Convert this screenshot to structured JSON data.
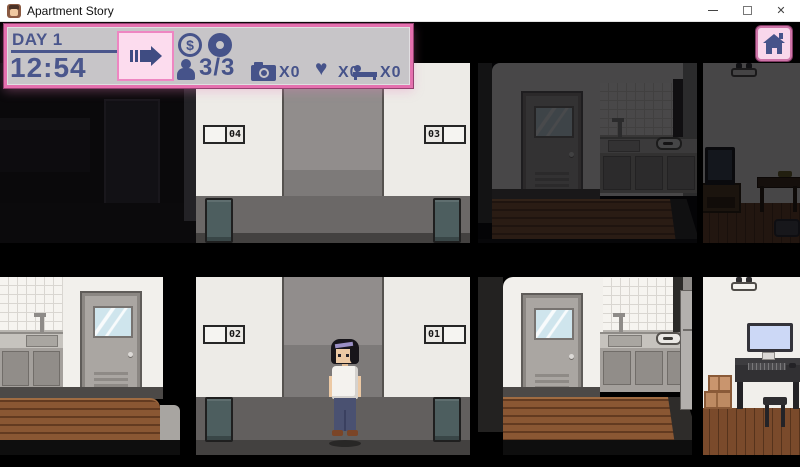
{
  "window": {
    "title": "Apartment Story",
    "close_glyph": "✕"
  },
  "hud": {
    "day": "DAY 1",
    "time": "12:54",
    "money_symbol": "$",
    "tenants": "3/3",
    "stats": {
      "camera": "x0",
      "heart": "x0",
      "bed": "x0"
    }
  },
  "rooms": {
    "plates": [
      "04",
      "03",
      "02",
      "01"
    ]
  },
  "icons": {
    "heart": "♥"
  },
  "colors": {
    "accent_pink": "#e470ae",
    "hud_panel_bg": "#c7c5c8",
    "hud_text_blue": "#46538a",
    "button_pink_bg": "#fcdcee"
  }
}
